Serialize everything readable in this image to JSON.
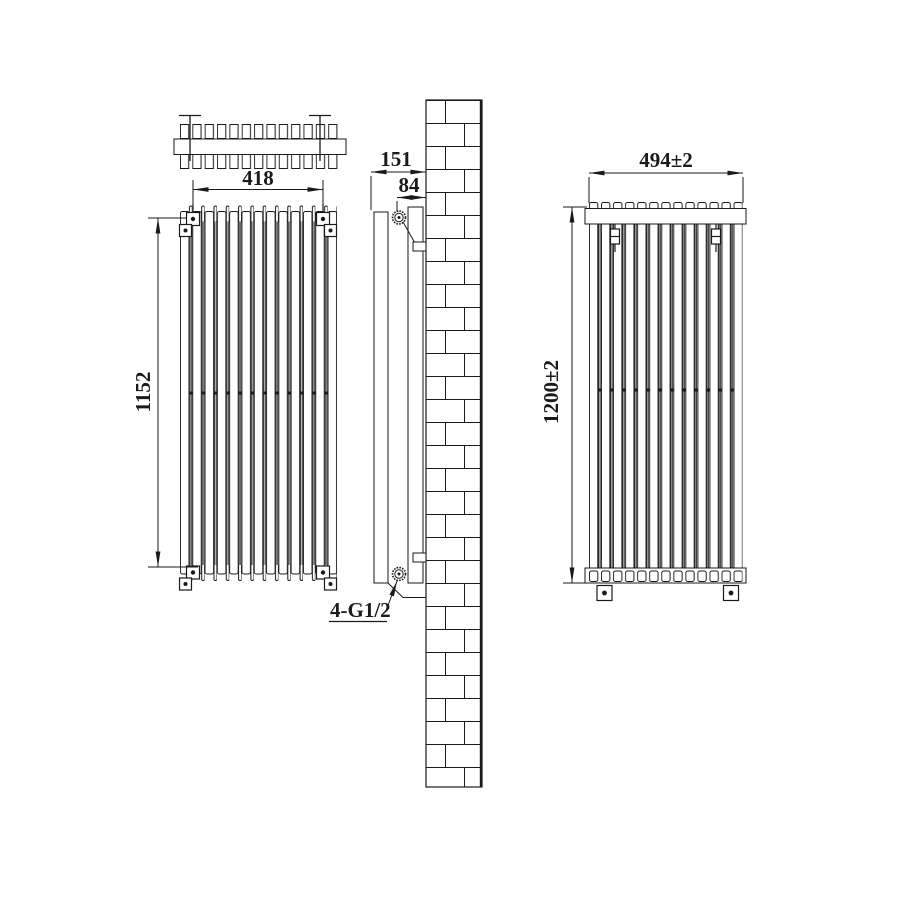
{
  "drawing": {
    "background": "#ffffff",
    "line_color": "#1a1a1a",
    "dimensions": {
      "front_left": {
        "width": "418",
        "height": "1152"
      },
      "side": {
        "depth": "151",
        "pipe_offset": "84",
        "connection": "4-G1/2"
      },
      "front_right": {
        "width": "494±2",
        "height": "1200±2"
      }
    }
  }
}
